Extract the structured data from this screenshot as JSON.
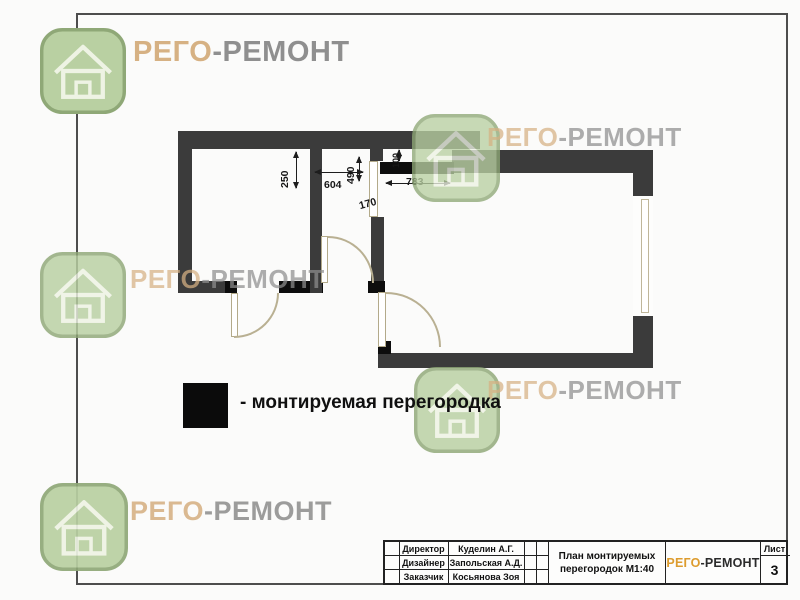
{
  "brand": {
    "first": "РЕГО",
    "second": "-РЕМОНТ"
  },
  "plan": {
    "dims": {
      "v250": "250",
      "h604": "604",
      "v490": "490",
      "d170": "170",
      "h783": "783",
      "v100": "100"
    }
  },
  "legend": {
    "label": "- монтируемая перегородка"
  },
  "title_block": {
    "rows": [
      {
        "role": "Директор",
        "name": "Куделин А.Г."
      },
      {
        "role": "Дизайнер",
        "name": "Запольская А.Д."
      },
      {
        "role": "Заказчик",
        "name": "Косьянова Зоя"
      }
    ],
    "title_line1": "План монтируемых",
    "title_line2": "перегородок М1:40",
    "sheet_label": "Лист",
    "sheet_number": "3",
    "logo_first": "РЕГО",
    "logo_second": "-РЕМОНТ"
  },
  "colors": {
    "wall": "#3b3b3b",
    "mounted_partition": "#0d0d0d",
    "brand_tan": "#d6b183",
    "brand_gray": "#8f8f8f",
    "logo_orange": "#dd9c2e",
    "watermark_green": "#b9d0a2"
  }
}
